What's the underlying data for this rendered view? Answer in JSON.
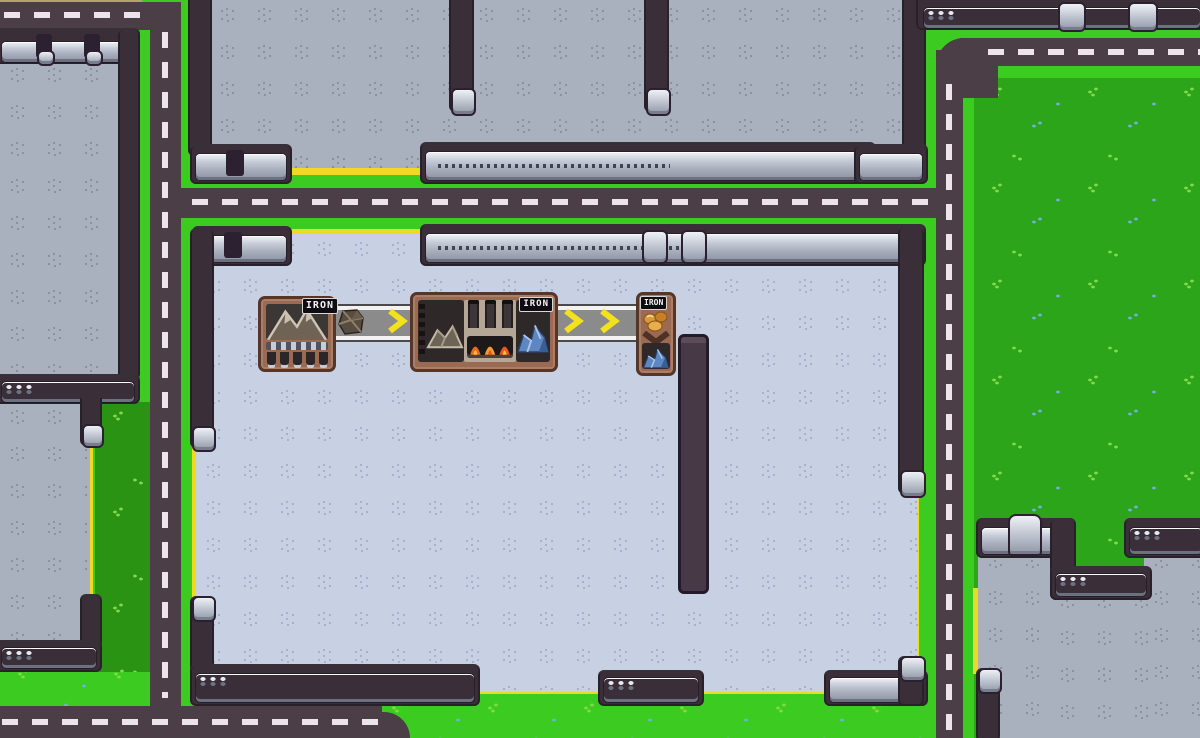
{
  "game": {
    "viewport": "factory-builder-top-down",
    "resource": "IRON"
  },
  "machines": [
    {
      "name": "iron-miner",
      "label": "IRON",
      "kind": "extractor-on-mountain"
    },
    {
      "name": "iron-smelter",
      "label": "IRON",
      "kind": "furnace-mountain-to-blue-ore"
    },
    {
      "name": "iron-depot",
      "label": "IRON",
      "kind": "converter-nuggets-to-blue-ore"
    }
  ],
  "belts": [
    {
      "name": "conveyor-belt-1",
      "direction": "right",
      "arrow_count": 1,
      "items": [
        "iron-ore-chunk"
      ]
    },
    {
      "name": "conveyor-belt-2",
      "direction": "right",
      "arrow_count": 2,
      "items": []
    }
  ],
  "icons": {
    "mountain": "mountain-icon",
    "iron_ore_pile": "iron-ore-pile-icon",
    "blue_ore_pile": "blue-ore-pile-icon",
    "gold_nuggets": "gold-nuggets-icon",
    "flames": "furnace-fire-icon",
    "belt_arrow": "belt-arrow-icon",
    "down_arrow": "down-arrow-icon"
  },
  "colors": {
    "road": "#4b3e47",
    "road-dash": "#ece4ea",
    "green-bright": "#3ccb20",
    "grass": "#2da51a",
    "grass-dark": "#2a9314",
    "tuft1": "#84da4a",
    "tuft2": "#6fb3dd",
    "floor-gray": "#a9b1bf",
    "floor-blue": "#c7d1e3",
    "dot-g": "#7f8799",
    "dot-b": "#9aa6c8",
    "wall": "#3a2e39",
    "yellow": "#eeda22",
    "frame-brown": "#9c6a52",
    "frame-border": "#573527",
    "panel-dark": "#2e2829",
    "chevron-yellow": "#f2e11c",
    "furnace-tan": "#b5a795",
    "label-bg": "#0f0d11",
    "label-text": "#f4f4f4"
  }
}
